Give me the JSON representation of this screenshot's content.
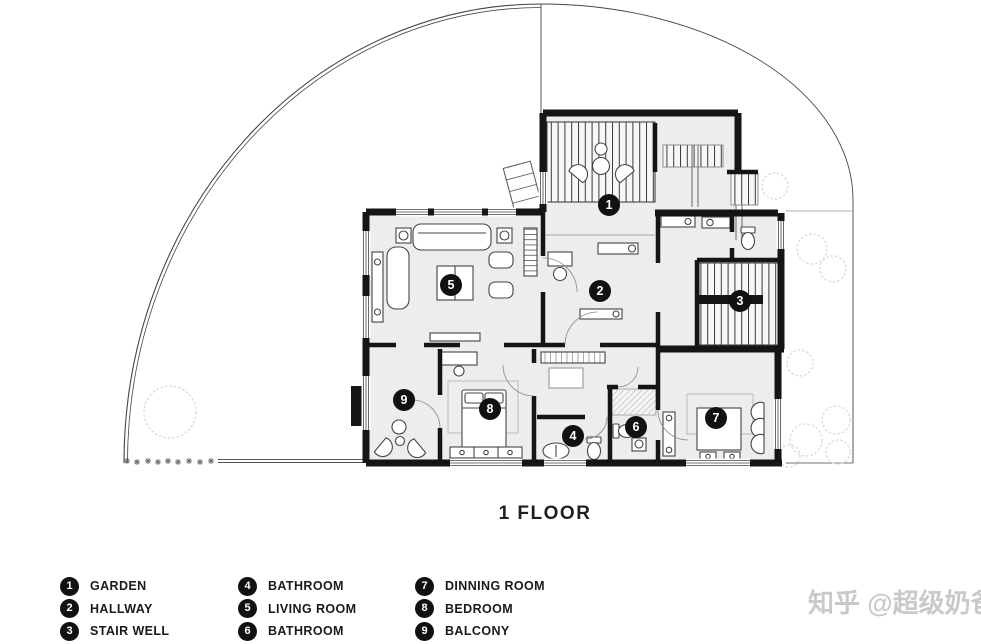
{
  "page": {
    "floor_title": "1 FLOOR",
    "watermark": "知乎 @超级奶爸"
  },
  "legend": {
    "items": [
      {
        "num": "1",
        "label": "GARDEN"
      },
      {
        "num": "2",
        "label": "HALLWAY"
      },
      {
        "num": "3",
        "label": "STAIR WELL"
      },
      {
        "num": "4",
        "label": "BATHROOM"
      },
      {
        "num": "5",
        "label": "LIVING ROOM"
      },
      {
        "num": "6",
        "label": "BATHROOM"
      },
      {
        "num": "7",
        "label": "DINNING ROOM"
      },
      {
        "num": "8",
        "label": "BEDROOM"
      },
      {
        "num": "9",
        "label": "BALCONY"
      }
    ]
  },
  "plan": {
    "markers": [
      {
        "num": "1",
        "room": "garden"
      },
      {
        "num": "2",
        "room": "hallway"
      },
      {
        "num": "3",
        "room": "stair-well"
      },
      {
        "num": "4",
        "room": "bathroom"
      },
      {
        "num": "5",
        "room": "living-room"
      },
      {
        "num": "6",
        "room": "bathroom-2"
      },
      {
        "num": "7",
        "room": "dinning-room"
      },
      {
        "num": "8",
        "room": "bedroom"
      },
      {
        "num": "9",
        "room": "balcony"
      }
    ]
  },
  "colors": {
    "wall": "#151515",
    "floor": "#ededed",
    "badge": "#111111",
    "boundary_line": "#444444",
    "tree_line": "#dcdcdc",
    "watermark": "#c9c9c9"
  }
}
